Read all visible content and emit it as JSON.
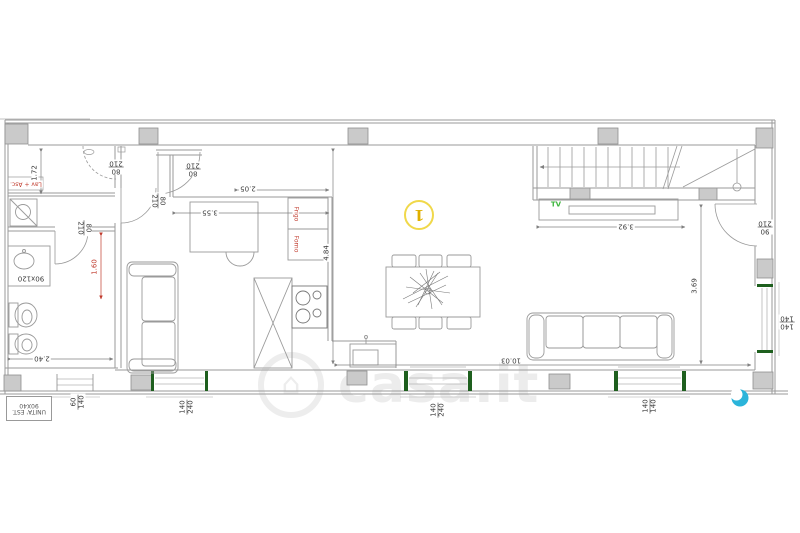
{
  "brand": {
    "name": "casa.it",
    "house_icon": "⌂",
    "text_color": "#ececec",
    "dot_color": "#2bb4da"
  },
  "level_badge": {
    "text": "1",
    "color": "#e0b000",
    "ring_color": "#f0d84a"
  },
  "appliance_labels": {
    "laundry": "Lav + Asc.",
    "vanity": "90x120",
    "fridge": "Frigo",
    "oven": "Forno",
    "tv": "TV"
  },
  "exterior_unit": {
    "line1": "UNITA' EST.",
    "line2": "90X40"
  },
  "doors": [
    {
      "w": "80",
      "h": "210"
    },
    {
      "w": "80",
      "h": "210"
    },
    {
      "w": "80",
      "h": "210"
    },
    {
      "w": "80",
      "h": "210"
    },
    {
      "w": "90",
      "h": "210"
    }
  ],
  "windows": [
    {
      "w": "60",
      "h": "140"
    },
    {
      "w": "140",
      "h": "240"
    },
    {
      "w": "140",
      "h": "240"
    },
    {
      "w": "140",
      "h": "140"
    },
    {
      "w": "140",
      "h": "140"
    }
  ],
  "dimensions": {
    "laundry_depth": "1.72",
    "kitchen_opening": "2.05",
    "kitchen_width": "3.55",
    "hall_depth": "4.84",
    "stair_width": "3.92",
    "living_depth": "3.69",
    "living_width": "10.03",
    "bath_width": "2.40",
    "bath_detail": "1.60"
  },
  "colors": {
    "wall_line": "#9a9a9a",
    "pillar_fill": "#cacaca",
    "sill_green": "#1e5f1e",
    "tv_green": "#3cb53c",
    "dim_red": "#c0392b",
    "badge_yellow": "#e0b000",
    "brand_blue": "#2bb4da"
  }
}
